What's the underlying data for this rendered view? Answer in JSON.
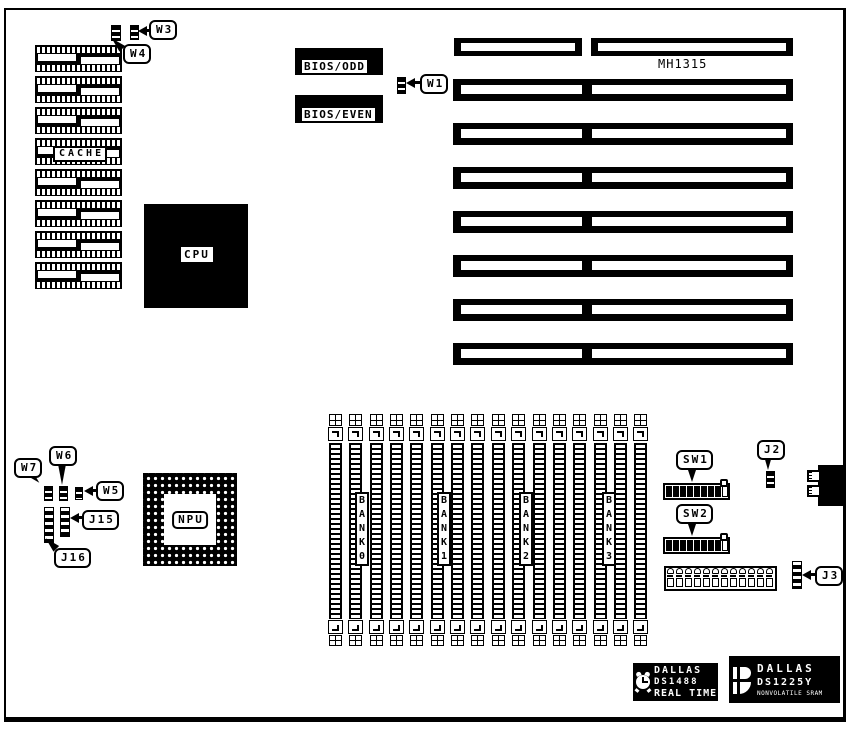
{
  "diagram": {
    "board_model": "MH1315",
    "component_labels": {
      "cache": "CACHE",
      "cpu": "CPU",
      "npu": "NPU",
      "bios_odd": "BIOS/ODD",
      "bios_even": "BIOS/EVEN"
    },
    "memory_banks": [
      "BANK0",
      "BANK1",
      "BANK2",
      "BANK3"
    ],
    "jumper_labels": {
      "w1": "W1",
      "w3": "W3",
      "w4": "W4",
      "w5": "W5",
      "w6": "W6",
      "w7": "W7",
      "j2": "J2",
      "j3": "J3",
      "j15": "J15",
      "j16": "J16",
      "sw1": "SW1",
      "sw2": "SW2"
    },
    "logos": {
      "rtc": {
        "brand": "DALLAS",
        "part": "DS1488",
        "tagline": "REAL TIME"
      },
      "nvram": {
        "brand": "DALLAS",
        "part": "DS1225Y",
        "tagline": "NONVOLATILE SRAM"
      }
    },
    "colors": {
      "ink": "#000000",
      "paper": "#ffffff"
    }
  }
}
